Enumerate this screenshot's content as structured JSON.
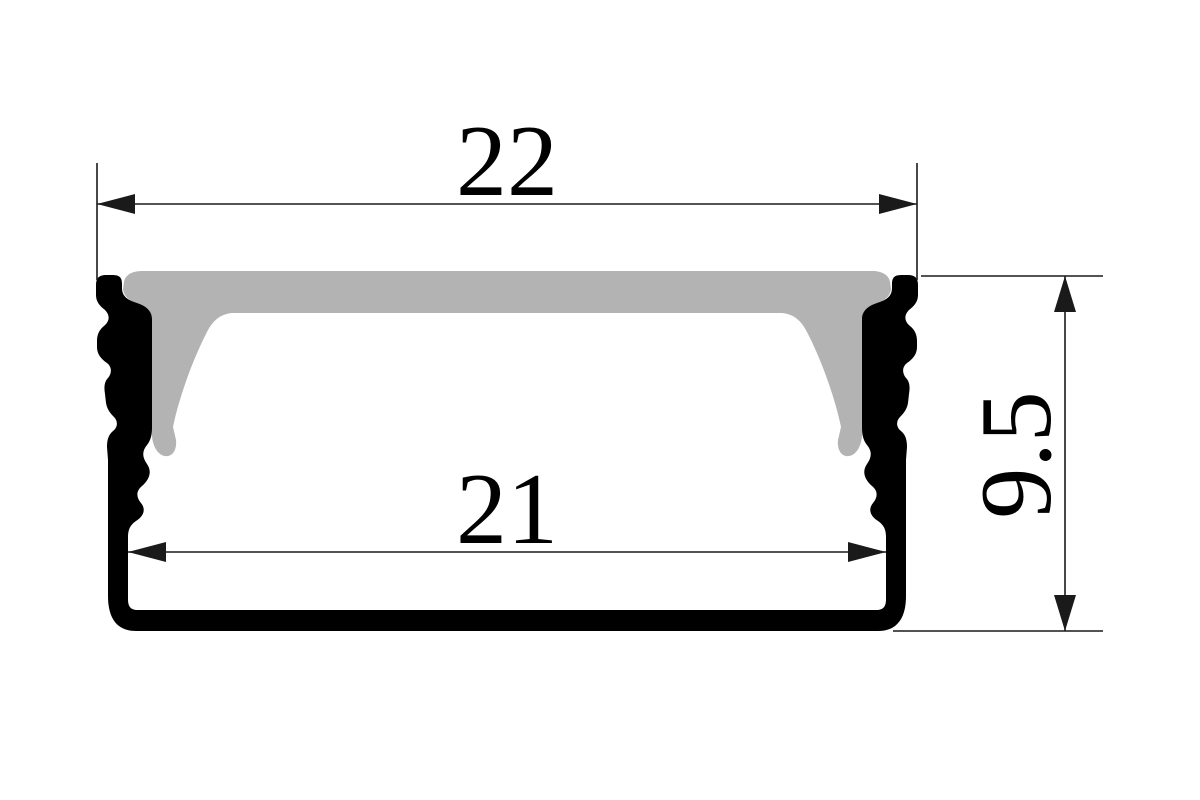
{
  "drawing": {
    "subject": "aluminium-led-profile-cross-section",
    "dimensions": {
      "overall_width": "22",
      "inner_width": "21",
      "overall_height": "9.5"
    },
    "colors": {
      "profile": "#000000",
      "diffuser": "#b3b3b3",
      "lines": "#1a1a1a"
    }
  }
}
